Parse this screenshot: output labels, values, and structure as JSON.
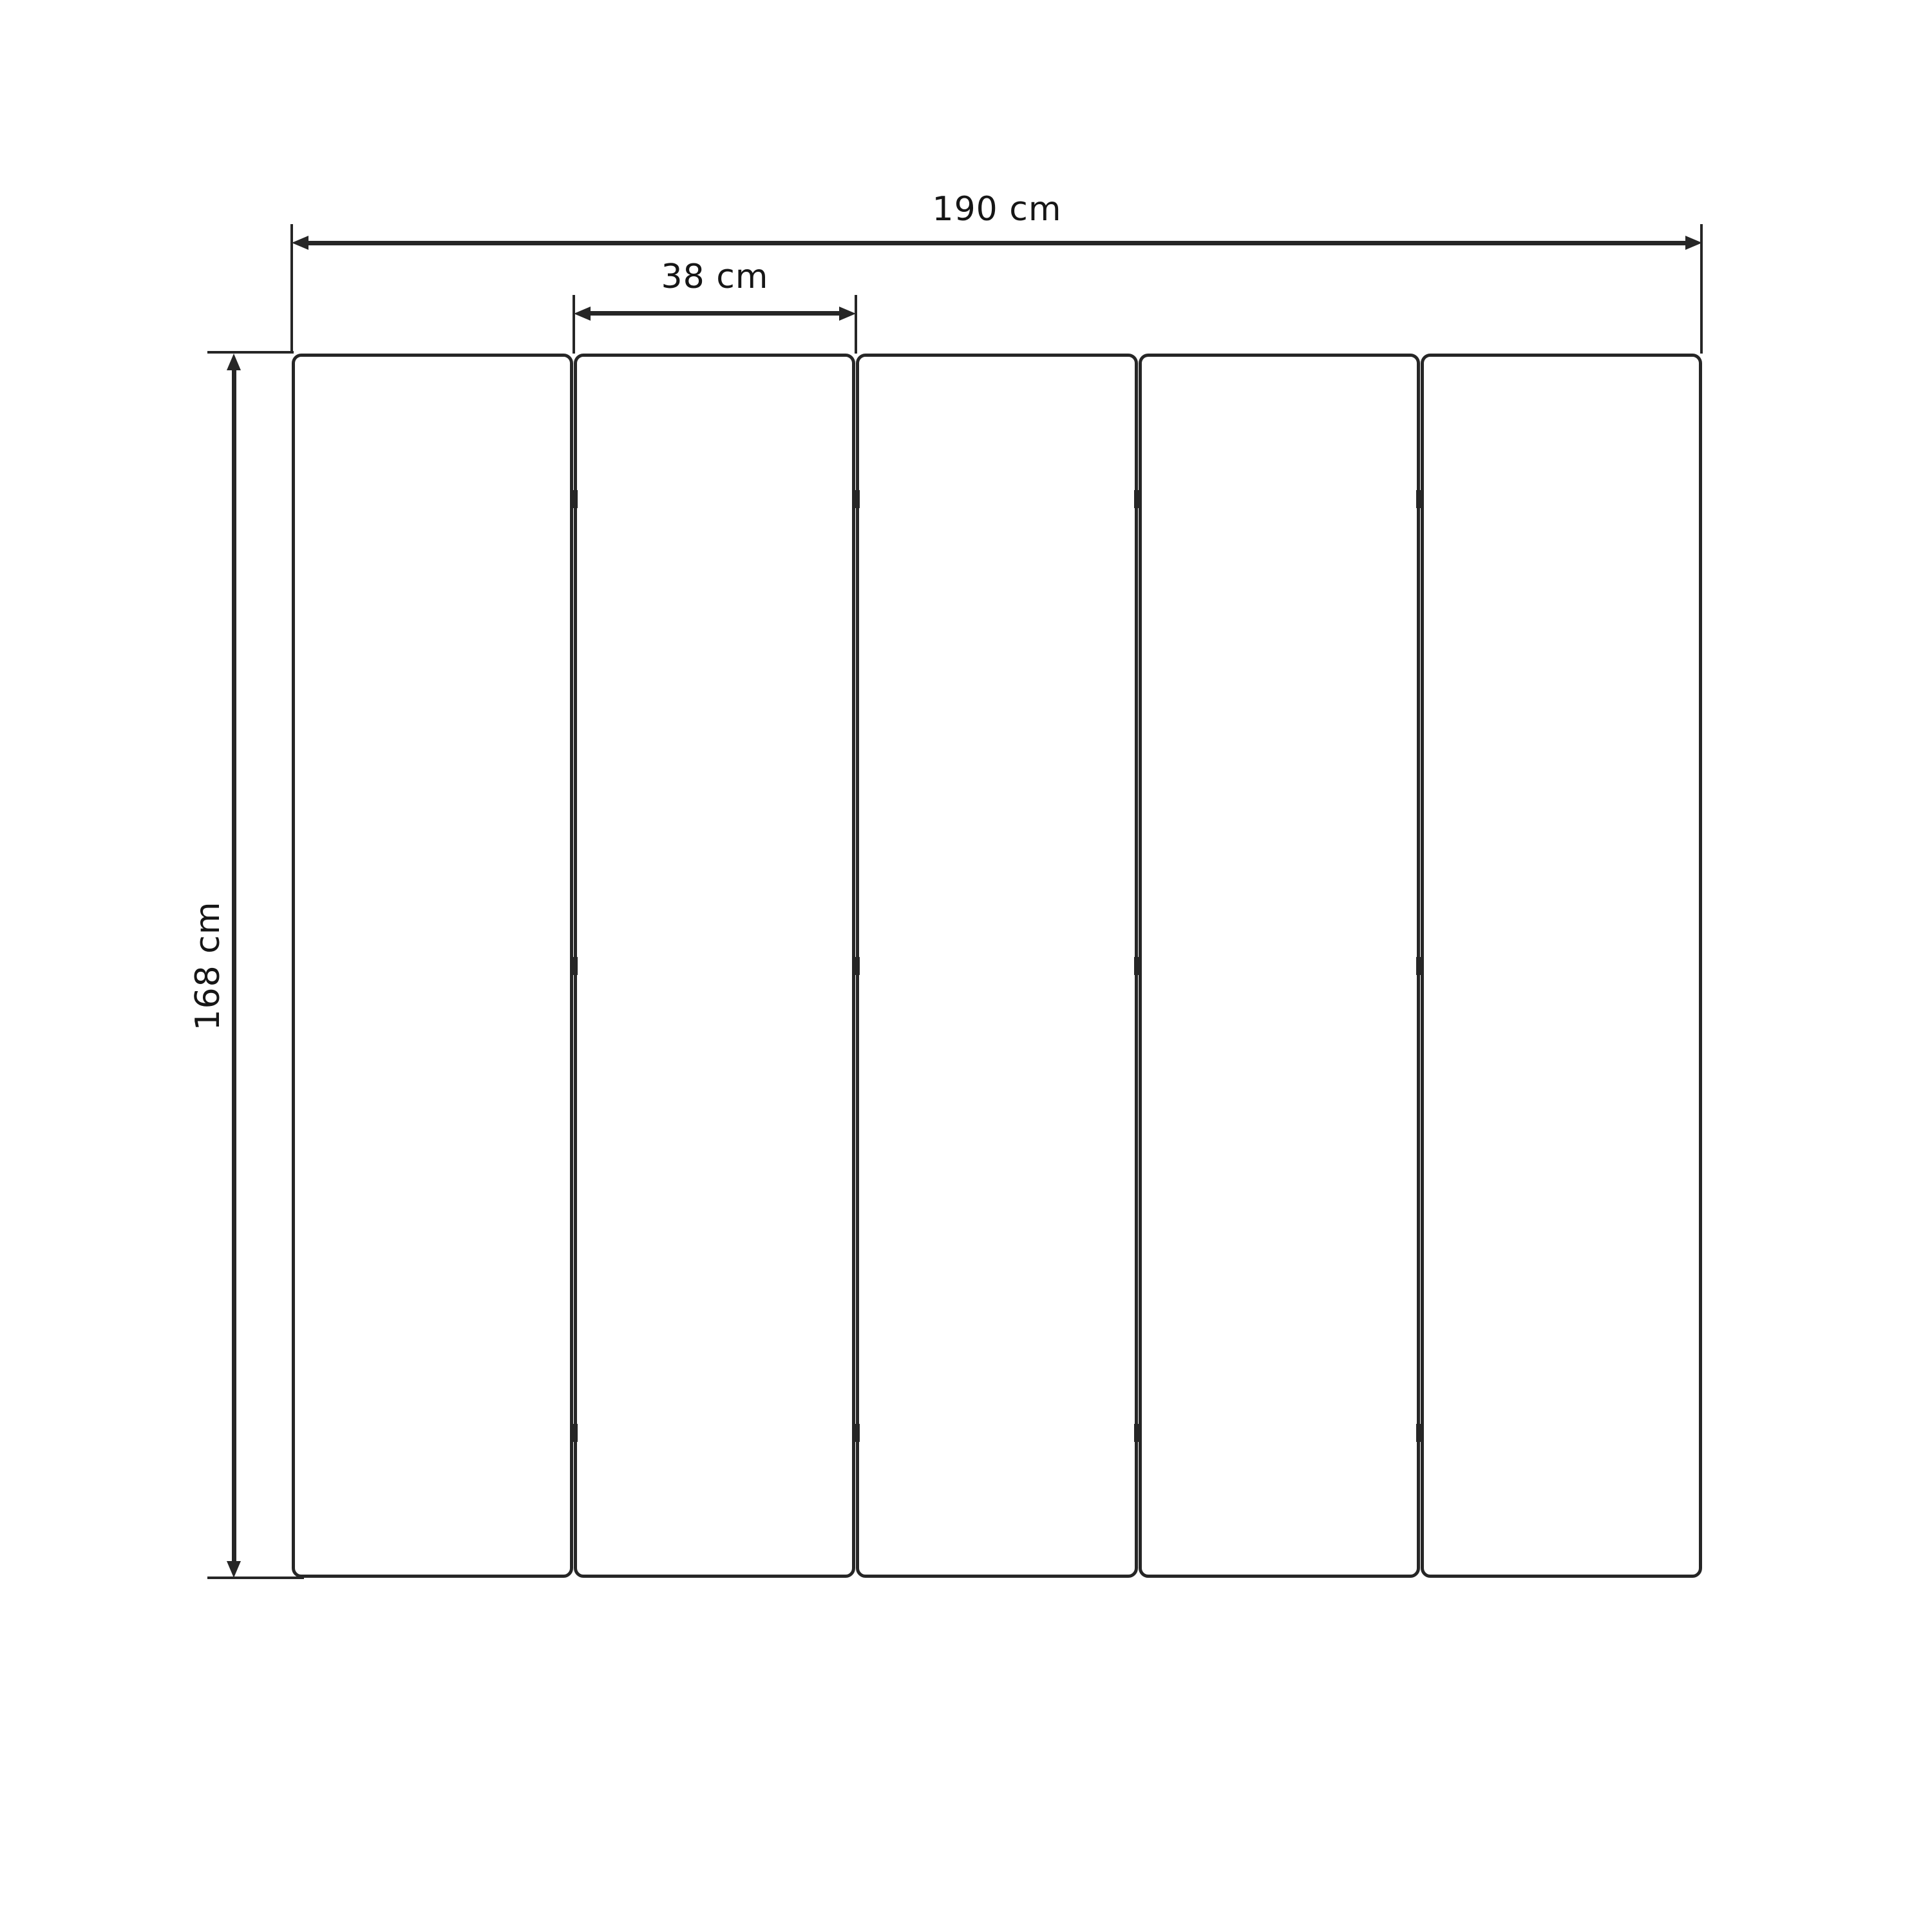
{
  "diagram": {
    "type": "dimension-drawing",
    "panel_count": 5,
    "hinge_rows": 3,
    "hinge_columns": 4,
    "dimensions": {
      "total_width": {
        "label": "190 cm",
        "value": 190,
        "unit": "cm"
      },
      "panel_width": {
        "label": "38 cm",
        "value": 38,
        "unit": "cm"
      },
      "height": {
        "label": "168 cm",
        "value": 168,
        "unit": "cm"
      }
    },
    "colors": {
      "line": "#262626",
      "text": "#161616",
      "background": "#ffffff"
    }
  }
}
